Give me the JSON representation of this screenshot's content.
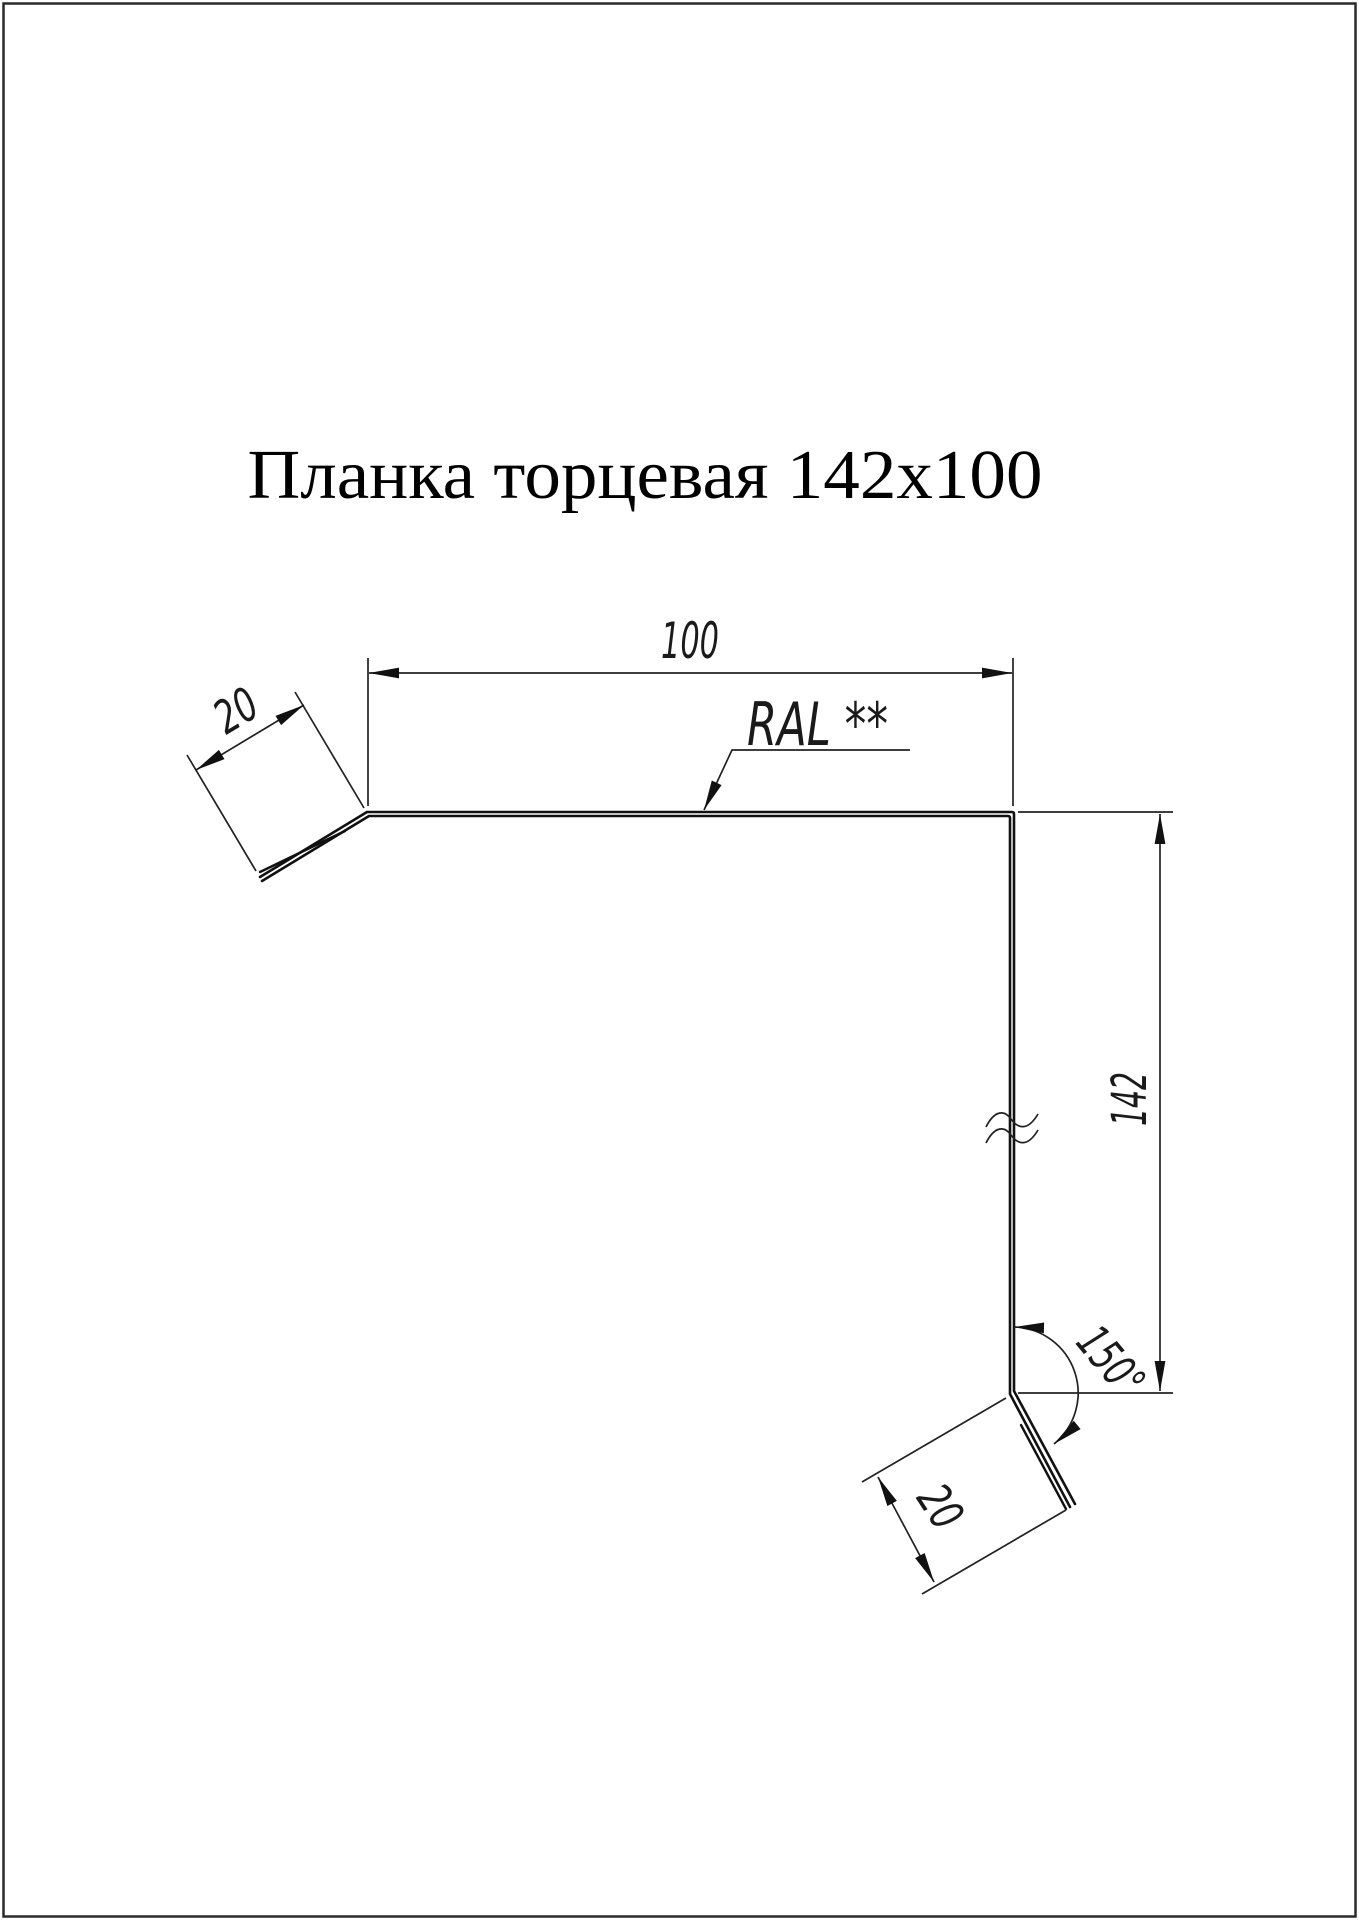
{
  "page": {
    "title": "Планка торцевая 142x100"
  },
  "drawing": {
    "type": "technical-profile-drawing",
    "product": "Планка торцевая",
    "size": "142x100",
    "labels": {
      "width_top": "100",
      "flange_top": "20",
      "height_right": "142",
      "flange_bottom": "20",
      "angle_bottom": "150°",
      "coating": "RAL **"
    },
    "colors": {
      "line": "#1a1a1a",
      "background": "#ffffff",
      "border": "#2a2a2a"
    }
  }
}
